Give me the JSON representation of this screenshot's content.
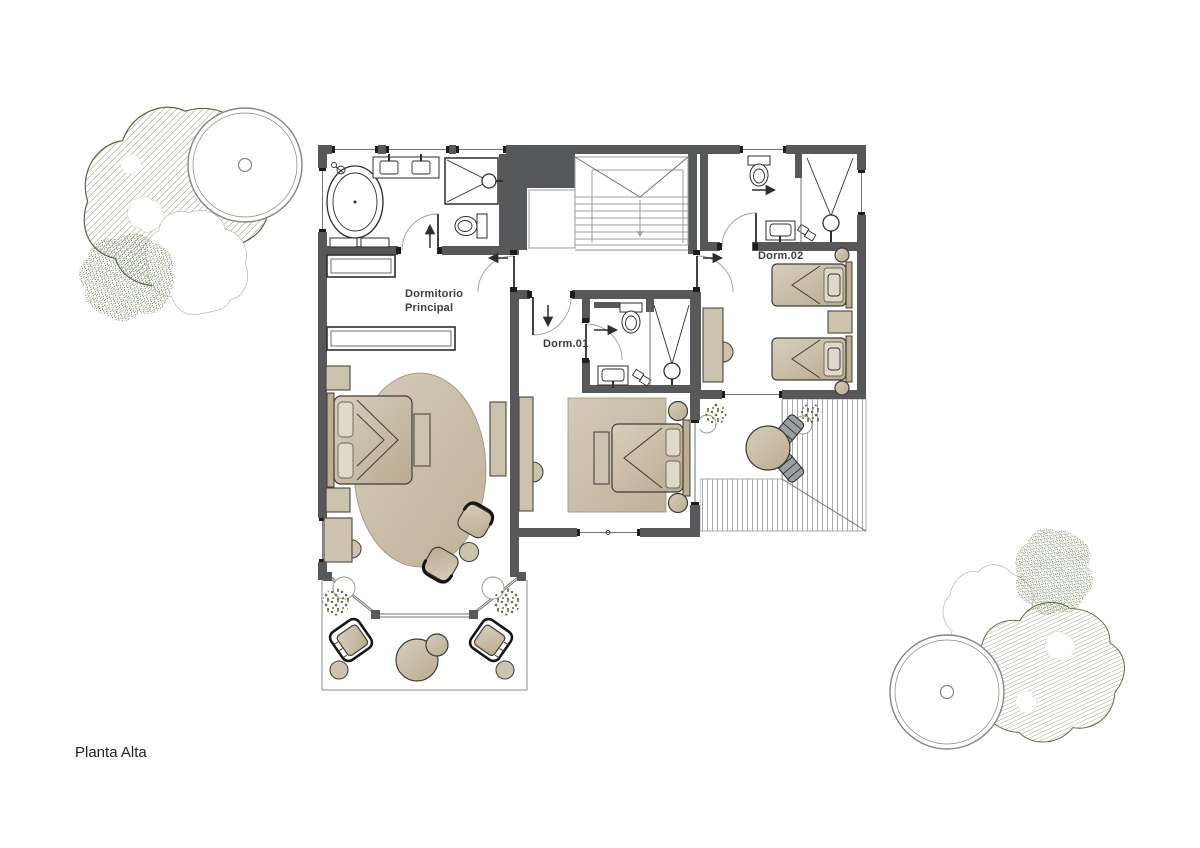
{
  "drawing": {
    "type": "architectural-floor-plan",
    "labels": {
      "floor": "Planta Alta",
      "master_line1": "Dormitorio",
      "master_line2": "Principal",
      "bedroom1": "Dorm.01",
      "bedroom2": "Dorm.02"
    },
    "rooms": [
      {
        "name": "Dormitorio Principal",
        "features": [
          "bathtub",
          "double-vanity",
          "shower",
          "toilet",
          "wardrobes",
          "double-bed",
          "oval-rug",
          "armchairs",
          "desk",
          "bay-window-terrace"
        ]
      },
      {
        "name": "Dorm.01",
        "features": [
          "double-bed",
          "rug",
          "desk",
          "ensuite-bath",
          "shower",
          "toilet",
          "sink"
        ]
      },
      {
        "name": "Dorm.02",
        "features": [
          "twin-beds",
          "nightstand",
          "desk",
          "ensuite-bath",
          "shower",
          "toilet",
          "sink",
          "deck-terrace"
        ]
      }
    ],
    "circulation": [
      "stairs-down",
      "hall-landing",
      "door-swings"
    ]
  },
  "colors": {
    "wall": "#57585a",
    "line": "#2e2e2c",
    "thin-line": "#8a8d90",
    "furniture-tan": "#cdc2ae",
    "furniture-tan-dark": "#bcae94",
    "pillow": "#e0d8c9",
    "rug": "#cbbfab",
    "leaf-green": "#5e7140",
    "hatch-green": "#7a8a64",
    "tree-outline": "#7d8a79",
    "tree-light": "#a9b3a1",
    "deck-line": "#a6abb0",
    "label-text": "#3c3c3b"
  }
}
